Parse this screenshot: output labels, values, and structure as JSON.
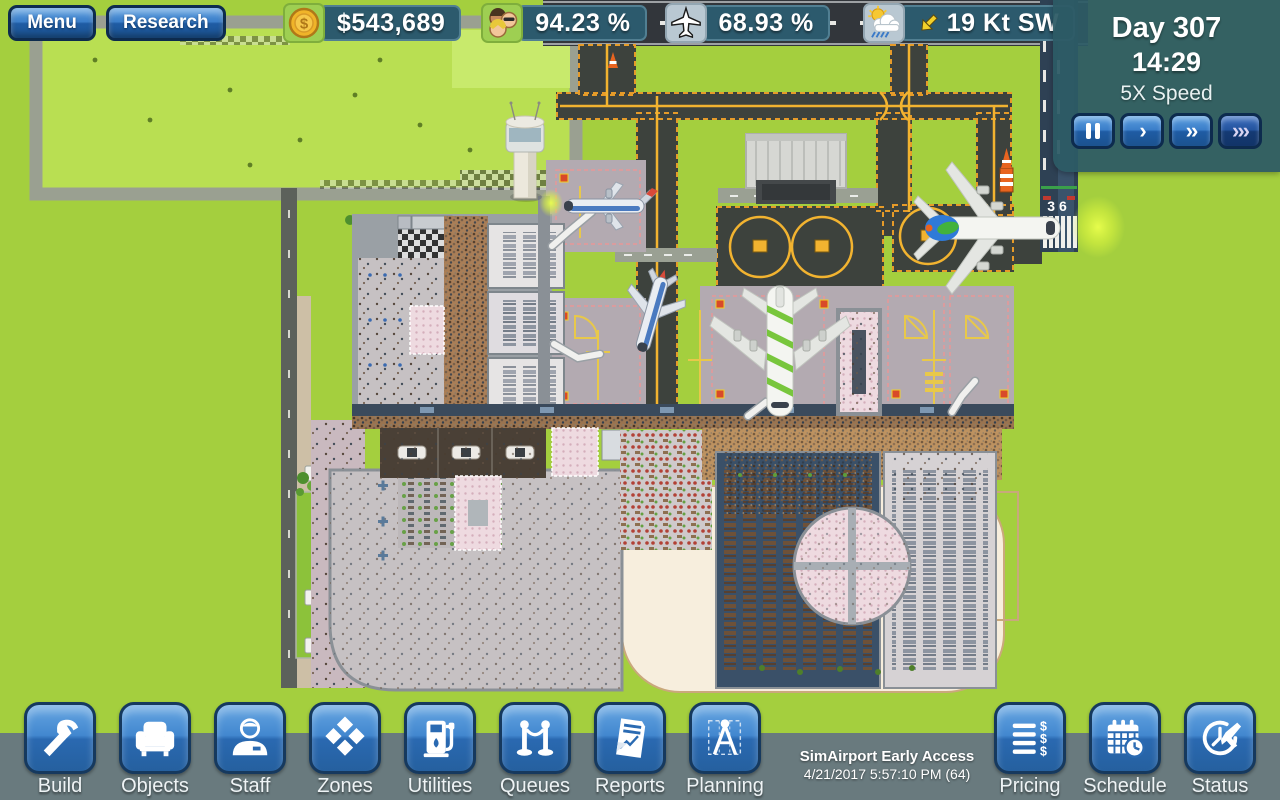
{
  "topbar": {
    "menu_label": "Menu",
    "research_label": "Research",
    "money": "$543,689",
    "passengers_pct": "94.23 %",
    "flights_pct": "68.93 %",
    "wind": "19 Kt SW"
  },
  "clock": {
    "day": "Day 307",
    "time": "14:29",
    "speed": "5X Speed",
    "play_glyph": "›",
    "fast_glyph": "››",
    "fastest_glyph": "›››"
  },
  "toolbar": {
    "items": [
      {
        "label": "Build"
      },
      {
        "label": "Objects"
      },
      {
        "label": "Staff"
      },
      {
        "label": "Zones"
      },
      {
        "label": "Utilities"
      },
      {
        "label": "Queues"
      },
      {
        "label": "Reports"
      },
      {
        "label": "Planning"
      },
      {
        "label": "Pricing"
      },
      {
        "label": "Schedule"
      },
      {
        "label": "Status"
      }
    ],
    "version_line1": "SimAirport Early Access",
    "version_line2": "4/21/2017 5:57:10 PM (64)"
  },
  "icons": {
    "dollar": "$"
  },
  "map": {
    "runway_number": "36"
  },
  "colors": {
    "grass": "#a4cf3e",
    "taxiway": "#3d423d",
    "taxi_line": "#f2b330",
    "panel_teal": "#2c5a6d",
    "button_blue": "#3b7ec9",
    "toolbar_gray": "#697a7e"
  }
}
